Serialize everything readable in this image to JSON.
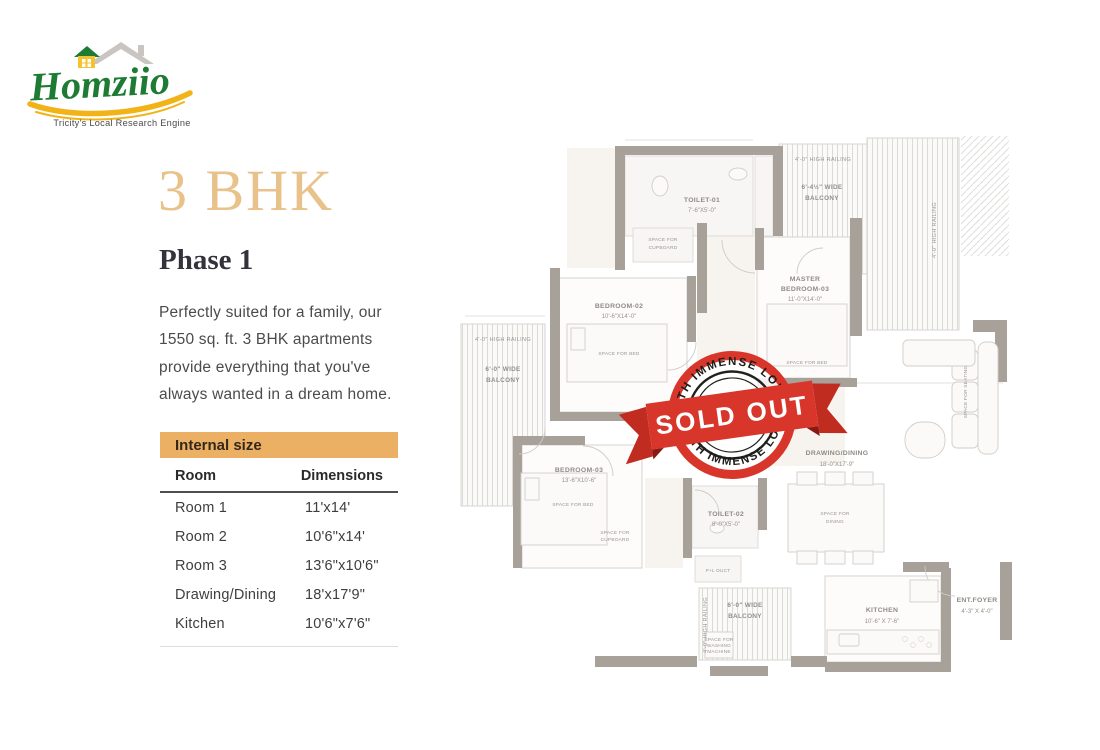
{
  "logo": {
    "brand": "Homziio",
    "tagline": "Tricity's Local Research Engine",
    "green": "#1e7b33",
    "yellow": "#f2b319"
  },
  "content": {
    "title": "3 BHK",
    "subtitle": "Phase 1",
    "description": "Perfectly suited for a family, our 1550 sq. ft. 3 BHK apartments provide everything that you've always wanted in a dream home."
  },
  "table": {
    "header": "Internal size",
    "header_bg": "#ecb065",
    "columns": [
      "Room",
      "Dimensions"
    ],
    "rows": [
      {
        "room": "Room 1",
        "dimensions": "11'x14'"
      },
      {
        "room": "Room 2",
        "dimensions": "10'6\"x14'"
      },
      {
        "room": "Room 3",
        "dimensions": "13'6\"x10'6\""
      },
      {
        "room": "Drawing/Dining",
        "dimensions": "18'x17'9\""
      },
      {
        "room": "Kitchen",
        "dimensions": "10'6\"x7'6\""
      }
    ]
  },
  "stamp": {
    "banner": "SOLD OUT",
    "arc_top": "WITH IMMENSE LOVE",
    "arc_bottom": "WITH IMMENSE LOVE",
    "color": "#d8352b"
  },
  "floorplan": {
    "toilet1_name": "TOILET-01",
    "toilet1_dims": "7'-6\"X5'-0\"",
    "toilet2_name": "TOILET-02",
    "toilet2_dims": "8'-0\"X5'-0\"",
    "bedroom2_name": "BEDROOM-02",
    "bedroom2_dims": "10'-6\"X14'-0\"",
    "bedroom3_name": "BEDROOM-03",
    "bedroom3_dims": "13'-6\"X10'-6\"",
    "master_name1": "MASTER",
    "master_name2": "BEDROOM-03",
    "master_dims": "11'-0\"X14'-0\"",
    "drawing_name": "DRAWING/DINING",
    "drawing_dims": "18'-0\"X17'-9\"",
    "kitchen_name": "KITCHEN",
    "kitchen_dims": "10'-6\" X 7'-6\"",
    "foyer_name": "ENT.FOYER",
    "foyer_dims": "4'-3\" X 4'-0\"",
    "railing": "4'-0\" HIGH RAILING",
    "balcony_top_l1": "6'-4½\" WIDE",
    "balcony_top_l2": "BALCONY",
    "balcony_left_l1": "6'-0\" WIDE",
    "balcony_left_l2": "BALCONY",
    "balcony_bottom_l1": "6'-0\" WIDE",
    "balcony_bottom_l2": "BALCONY",
    "space_bed": "SPACE FOR BED",
    "space_cupboard_l1": "SPACE FOR",
    "space_cupboard_l2": "CUPBOARD",
    "space_dining_l1": "SPACE FOR",
    "space_dining_l2": "DINING",
    "space_seating": "SPACE FOR SEATING",
    "washing_l1": "SPACE FOR",
    "washing_l2": "WASHING",
    "washing_l3": "MACHINE",
    "duct": "P+L DUCT"
  }
}
